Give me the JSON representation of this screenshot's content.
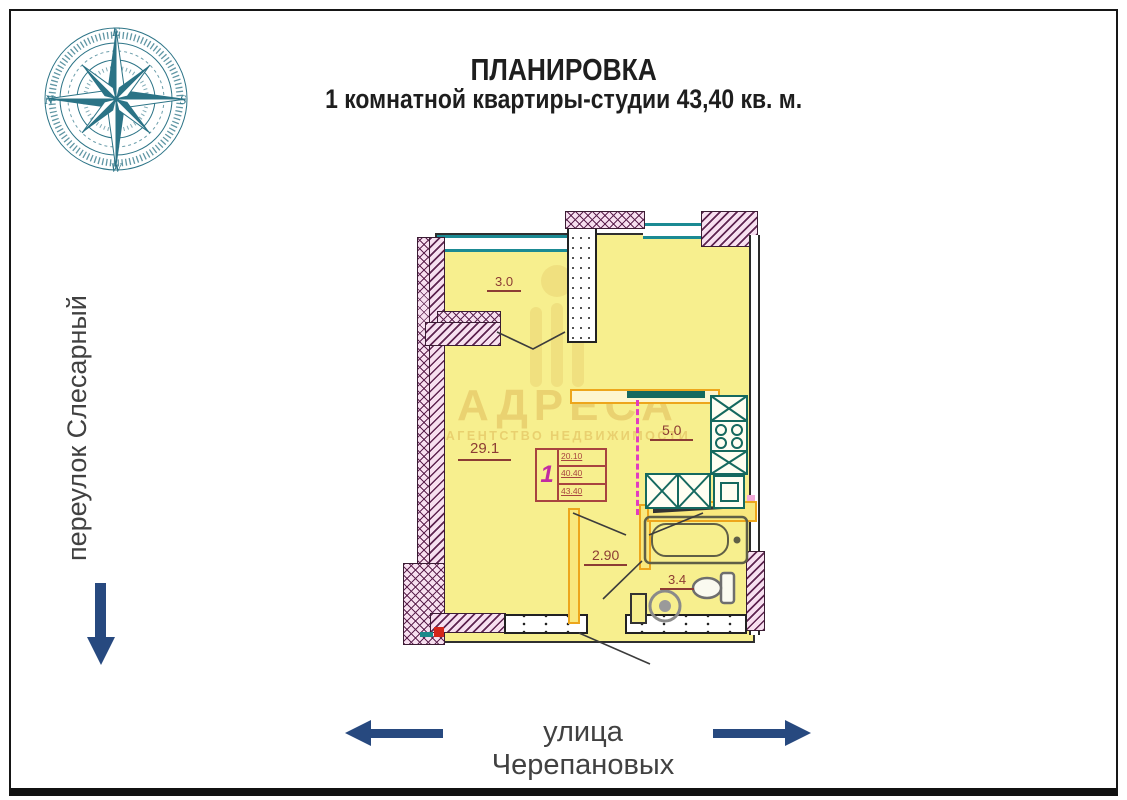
{
  "page": {
    "title_line1": "ПЛАНИРОВКА",
    "title_line2": "1 комнатной квартиры-студии 43,40 кв. м."
  },
  "compass": {
    "top": "E",
    "right": "S",
    "bottom": "W",
    "left": "N"
  },
  "streets": {
    "left_vertical": "переулок Слесарный",
    "bottom_horizontal": "улица Черепановых"
  },
  "plan": {
    "rooms": [
      {
        "name": "loggia",
        "area": "3.0"
      },
      {
        "name": "living-room",
        "area": "29.1"
      },
      {
        "name": "kitchen",
        "area": "5.0"
      },
      {
        "name": "hallway",
        "area": "2.90"
      },
      {
        "name": "bathroom",
        "area": "3.4"
      }
    ],
    "stamp": {
      "apartment_number": "1",
      "rows": [
        "20.10",
        "40.40",
        "43.40"
      ]
    }
  },
  "watermark": {
    "line1": "АДРЕСА",
    "line2": "АГЕНТСТВО НЕДВИЖИМОСТИ"
  },
  "colors": {
    "navy": "#27497f",
    "compass-teal": "#2b7386",
    "plan-yellow": "#f7ef8e",
    "wall-pink": "#f7e0f0",
    "wall-line": "#5e2450",
    "window-teal": "#1b8a93",
    "fixture-teal": "#15695f",
    "inner-orange": "#eda61c",
    "magenta-dash": "#e23cc0",
    "maroon": "#8c3c34",
    "stamp-magenta": "#c22ba3",
    "watermark-gold": "#e0ba5a",
    "street-text": "#414141",
    "title-text": "#1e1e1e"
  }
}
